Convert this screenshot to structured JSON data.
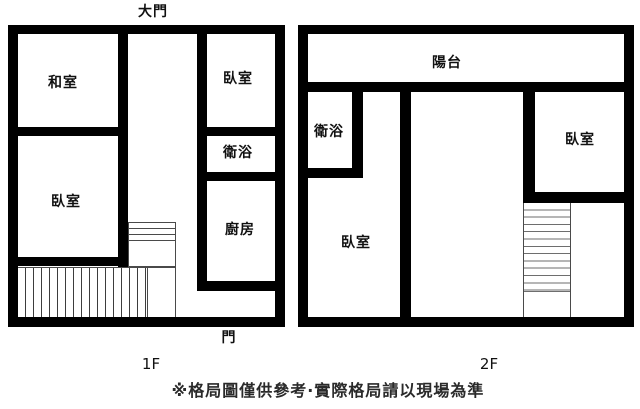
{
  "floor1": {
    "label": "1F",
    "entrance_label": "大門",
    "door_label": "門",
    "rooms": {
      "tatami": "和室",
      "bedroom_top": "臥室",
      "bathroom": "衛浴",
      "bedroom_left": "臥室",
      "kitchen": "廚房"
    }
  },
  "floor2": {
    "label": "2F",
    "rooms": {
      "balcony": "陽台",
      "bathroom": "衛浴",
      "bedroom_left": "臥室",
      "bedroom_right": "臥室"
    }
  },
  "footer": {
    "disclaimer": "※格局圖僅供參考·實際格局請以現場為準"
  },
  "colors": {
    "wall": "#000000",
    "background": "#ffffff",
    "text": "#111111"
  }
}
